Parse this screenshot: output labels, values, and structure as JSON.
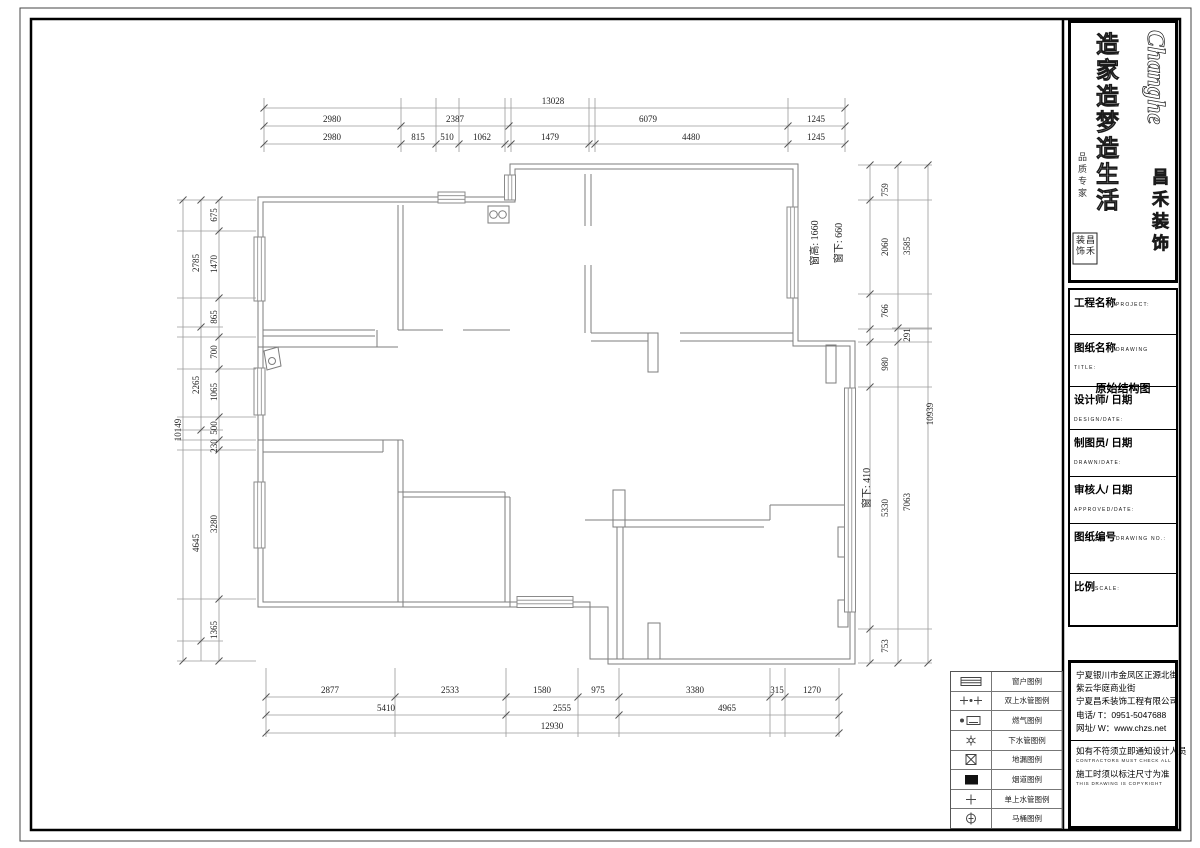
{
  "logo": {
    "brand_en": "Changhe",
    "brand_cn": "昌禾装饰",
    "slogan_1": "造家",
    "slogan_2": "造梦",
    "slogan_3": "造生活",
    "side_text": "品质专家",
    "seal_text_right": "昌禾",
    "seal_text_left": "装饰"
  },
  "title_block": {
    "rows": [
      {
        "label": "工程名称",
        "en": "PROJECT:"
      },
      {
        "label": "图纸名称",
        "en": "DRAWING TITLE:",
        "value": "原始结构图"
      },
      {
        "label": "设计师/ 日期",
        "en": "DESIGN/DATE:"
      },
      {
        "label": "制图员/ 日期",
        "en": "DRAWN/DATE:"
      },
      {
        "label": "审核人/ 日期",
        "en": "APPROVED/DATE:"
      },
      {
        "label": "图纸编号",
        "en": "DRAWING NO.:"
      },
      {
        "label": "比例",
        "en": "SCALE:"
      }
    ]
  },
  "company": {
    "lines": [
      "宁夏银川市金凤区正源北街",
      "紫云华庭商业街",
      "宁夏昌禾装饰工程有限公司",
      "电话/ T：0951-5047688",
      "网址/ W：www.chzs.net"
    ],
    "notes": [
      {
        "cn": "如有不符须立即通知设计人员",
        "en": "CONTRACTORS MUST CHECK ALL"
      },
      {
        "cn": "施工时须以标注尺寸为准",
        "en": "THIS DRAWING IS COPYRIGHT"
      }
    ]
  },
  "legend": {
    "rows": [
      {
        "symbol": "window",
        "label": "窗户图例"
      },
      {
        "symbol": "double-water-pipe",
        "label": "双上水管图例"
      },
      {
        "symbol": "gas",
        "label": "燃气图例"
      },
      {
        "symbol": "down-water-pipe",
        "label": "下水管图例"
      },
      {
        "symbol": "floor-drain",
        "label": "地漏图例"
      },
      {
        "symbol": "flue",
        "label": "烟道图例"
      },
      {
        "symbol": "single-water-pipe",
        "label": "单上水管图例"
      },
      {
        "symbol": "toilet",
        "label": "马桶图例"
      }
    ]
  },
  "plan": {
    "annotations": [
      {
        "t": "窗高: 1660",
        "x": 818,
        "y": 243
      },
      {
        "t": "窗下: 660",
        "x": 842,
        "y": 243
      },
      {
        "t": "窗下: 410",
        "x": 870,
        "y": 488
      }
    ]
  },
  "dims": [
    {
      "rot": false,
      "items": [
        {
          "t": "13028",
          "x": 553,
          "y": 104
        }
      ]
    },
    {
      "rot": false,
      "items": [
        {
          "t": "2980",
          "x": 332,
          "y": 122
        },
        {
          "t": "2387",
          "x": 455,
          "y": 122
        },
        {
          "t": "6079",
          "x": 648,
          "y": 122
        },
        {
          "t": "1245",
          "x": 816,
          "y": 122
        }
      ]
    },
    {
      "rot": false,
      "items": [
        {
          "t": "2980",
          "x": 332,
          "y": 140
        },
        {
          "t": "815",
          "x": 418,
          "y": 140
        },
        {
          "t": "510",
          "x": 447,
          "y": 140
        },
        {
          "t": "1062",
          "x": 482,
          "y": 140
        },
        {
          "t": "1479",
          "x": 550,
          "y": 140
        },
        {
          "t": "4480",
          "x": 691,
          "y": 140
        },
        {
          "t": "1245",
          "x": 816,
          "y": 140
        }
      ]
    },
    {
      "rot": false,
      "items": [
        {
          "t": "2877",
          "x": 330,
          "y": 693
        },
        {
          "t": "2533",
          "x": 450,
          "y": 693
        },
        {
          "t": "1580",
          "x": 542,
          "y": 693
        },
        {
          "t": "975",
          "x": 598,
          "y": 693
        },
        {
          "t": "3380",
          "x": 695,
          "y": 693
        },
        {
          "t": "315",
          "x": 777,
          "y": 693
        },
        {
          "t": "1270",
          "x": 812,
          "y": 693
        }
      ]
    },
    {
      "rot": false,
      "items": [
        {
          "t": "5410",
          "x": 386,
          "y": 711
        },
        {
          "t": "2555",
          "x": 562,
          "y": 711
        },
        {
          "t": "4965",
          "x": 727,
          "y": 711
        }
      ]
    },
    {
      "rot": false,
      "items": [
        {
          "t": "12930",
          "x": 552,
          "y": 729
        }
      ]
    },
    {
      "rot": true,
      "items": [
        {
          "t": "10149",
          "x": 181,
          "y": 430
        },
        {
          "t": "2785",
          "x": 199,
          "y": 263
        },
        {
          "t": "2265",
          "x": 199,
          "y": 385
        },
        {
          "t": "4645",
          "x": 199,
          "y": 543
        },
        {
          "t": "675",
          "x": 217,
          "y": 215
        },
        {
          "t": "1470",
          "x": 217,
          "y": 264
        },
        {
          "t": "865",
          "x": 217,
          "y": 317
        },
        {
          "t": "700",
          "x": 217,
          "y": 352
        },
        {
          "t": "1065",
          "x": 217,
          "y": 392
        },
        {
          "t": "500",
          "x": 217,
          "y": 428
        },
        {
          "t": "230",
          "x": 217,
          "y": 446
        },
        {
          "t": "3280",
          "x": 217,
          "y": 524
        },
        {
          "t": "1365",
          "x": 217,
          "y": 630
        }
      ]
    },
    {
      "rot": true,
      "items": [
        {
          "t": "759",
          "x": 888,
          "y": 190
        },
        {
          "t": "2060",
          "x": 888,
          "y": 247
        },
        {
          "t": "766",
          "x": 888,
          "y": 311
        },
        {
          "t": "980",
          "x": 888,
          "y": 364
        },
        {
          "t": "5330",
          "x": 888,
          "y": 508
        },
        {
          "t": "753",
          "x": 888,
          "y": 646
        },
        {
          "t": "3585",
          "x": 910,
          "y": 246
        },
        {
          "t": "291",
          "x": 910,
          "y": 335
        },
        {
          "t": "7063",
          "x": 910,
          "y": 502
        },
        {
          "t": "10939",
          "x": 933,
          "y": 414
        }
      ]
    }
  ]
}
